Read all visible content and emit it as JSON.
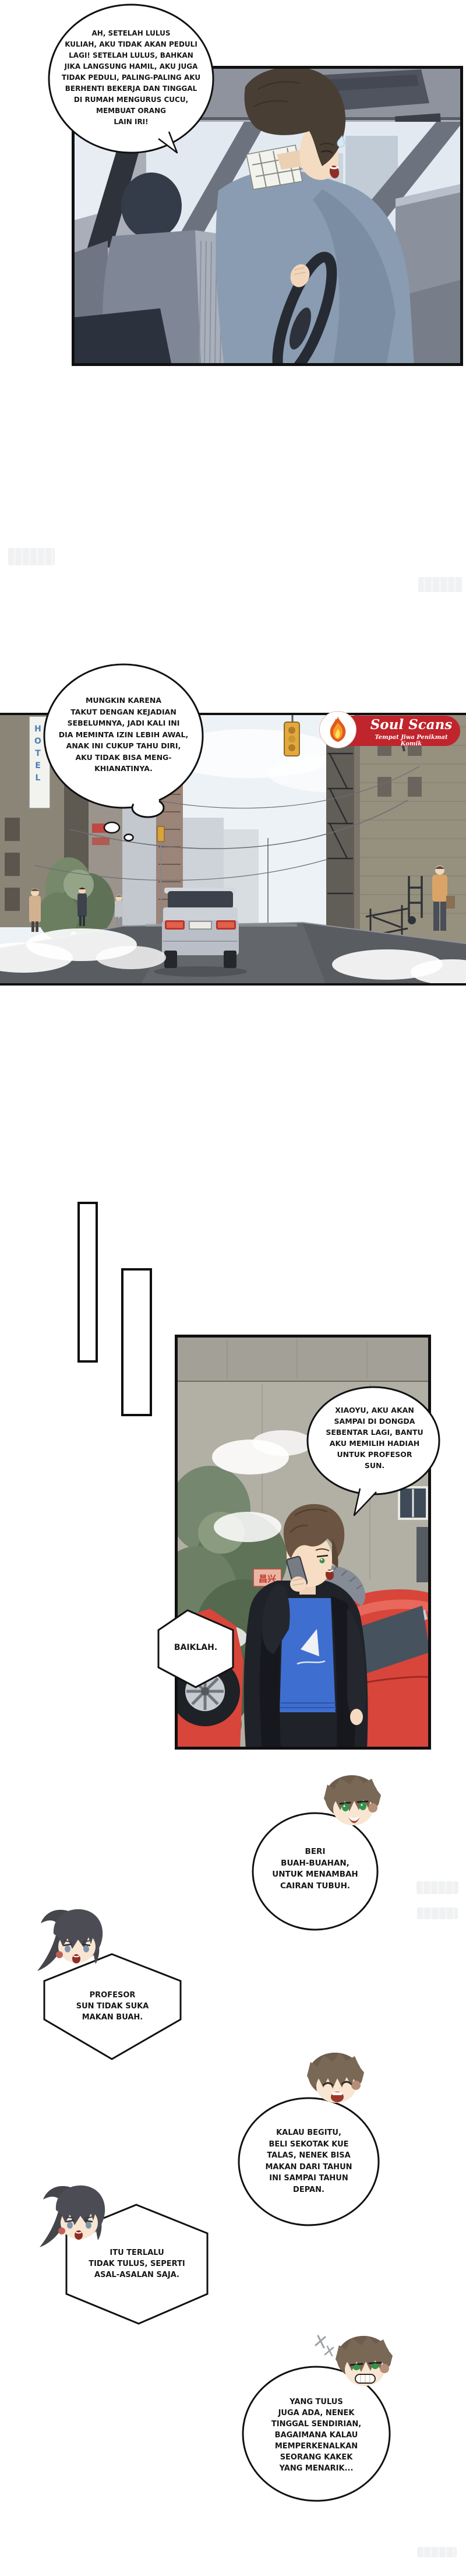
{
  "page": {
    "kind": "webtoon-comic-page",
    "language": "Indonesian"
  },
  "bubbles": {
    "driver": {
      "shape": "ellipse",
      "text": "AH, SETELAH LULUS\nKULIAH, AKU TIDAK AKAN PEDULI\nLAGI! SETELAH LULUS, BAHKAN\nJIKA LANGSUNG HAMIL, AKU JUGA\nTIDAK PEDULI, PALING-PALING AKU\nBERHENTI BEKERJA DAN TINGGAL\nDI RUMAH MENGURUS CUCU,\nMEMBUAT ORANG\nLAIN IRI!"
    },
    "street_thought": {
      "shape": "thought-cloud",
      "text": "MUNGKIN KARENA\nTAKUT DENGAN KEJADIAN\nSEBELUMNYA, JADI KALI INI\nDIA MEMINTA IZIN LEBIH AWAL,\nANAK INI CUKUP TAHU DIRI,\nAKU TIDAK BISA MENG-\nKHIANATINYA."
    },
    "phone_call": {
      "shape": "ellipse",
      "text": "XIAOYU, AKU AKAN\nSAMPAI DI DONGDA\nSEBENTAR LAGI, BANTU\nAKU MEMILIH HADIAH\nUNTUK PROFESOR\nSUN."
    },
    "reply": {
      "shape": "hexagon",
      "text": "BAIKLAH."
    }
  },
  "chat": [
    {
      "speaker": "chibi-boy",
      "side": "right",
      "shape": "circle",
      "text": "BERI\nBUAH-BUAHAN,\nUNTUK MENAMBAH\nCAIRAN TUBUH."
    },
    {
      "speaker": "chibi-girl",
      "side": "left",
      "shape": "hexagon",
      "text": "PROFESOR\nSUN TIDAK SUKA\nMAKAN BUAH."
    },
    {
      "speaker": "chibi-boy",
      "side": "right",
      "shape": "circle",
      "text": "KALAU BEGITU,\nBELI SEKOTAK KUE\nTALAS, NENEK BISA\nMAKAN DARI TAHUN\nINI SAMPAI TAHUN\nDEPAN."
    },
    {
      "speaker": "chibi-girl",
      "side": "left",
      "shape": "hexagon",
      "text": "ITU TERLALU\nTIDAK TULUS, SEPERTI\nASAL-ASALAN SAJA."
    },
    {
      "speaker": "chibi-boy",
      "side": "right",
      "shape": "circle",
      "text": "YANG TULUS\nJUGA ADA, NENEK\nTINGGAL SENDIRIAN,\nBAGAIMANA KALAU\nMEMPERKENALKAN\nSEORANG KAKEK\nYANG MENARIK..."
    }
  ],
  "scanlation_logo": {
    "title": "Soul Scans",
    "tagline": "Tempat Jiwa Penikmat Komik",
    "badge": "flame-icon",
    "color": "#c0242c"
  },
  "signs": {
    "hotel_vertical_sign": "HOTEL",
    "wall_shop_sign": "昌兴"
  },
  "colors": {
    "logo_red": "#c0242c",
    "sports_car_red": "#d8453a",
    "shirt_blue": "#3e6ecf",
    "hotel_sign_blue": "#4a80b8",
    "traffic_light_amber": "#e3a93e",
    "panel_border": "#111111"
  }
}
